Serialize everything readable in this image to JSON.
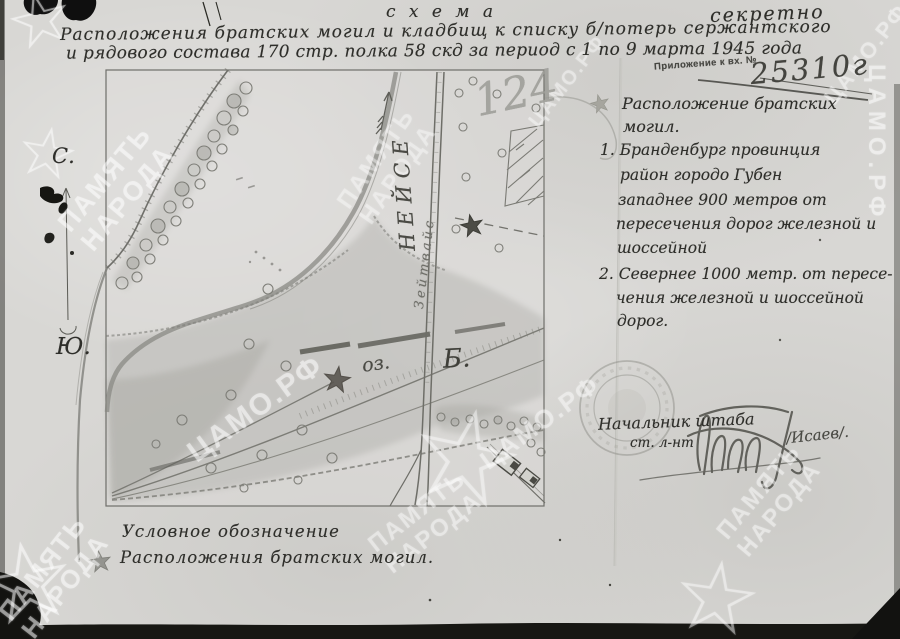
{
  "document": {
    "schema_label": "с х е м а",
    "secrecy_label": "секретно",
    "title_lines": [
      "Расположения братских могил и кладбищ к списку б/потерь сержантского",
      "и рядового состава 170 стр. полка 58 скд за период с 1 по 9 марта 1945 года"
    ],
    "registration_stamp": {
      "label": "Приложение к вх. №",
      "number": "25310г"
    }
  },
  "map": {
    "compass": {
      "north": "С.",
      "south": "Ю."
    },
    "river_label": "НЕЙСЕ",
    "road_label": "Зейтвайс",
    "lake_label": "оз.",
    "settlement_label": "Б.",
    "pencil_note": "124"
  },
  "notes": {
    "heading_lines": [
      "Расположение братских",
      "могил."
    ],
    "item1_lines": [
      "1. Бранденбург провинция",
      "район городо Губен",
      "западнее 900 метров от",
      "пересечения дорог железной и",
      "шоссейной"
    ],
    "item2_lines": [
      "2. Севернее 1000 метр. от пересе-",
      "чения железной и шоссейной",
      "дорог."
    ]
  },
  "signature": {
    "position_line1": "Начальник штаба",
    "position_line2": "ст. л-нт",
    "name": "/Исаев/."
  },
  "legend": {
    "title": "Условное обозначение",
    "item_label": "Расположения братских могил."
  },
  "watermarks": {
    "archive": "ЦАМО.РФ",
    "memory_line1": "ПАМЯТЬ",
    "memory_line2": "НАРОДА",
    "star_glyph": "☆"
  }
}
